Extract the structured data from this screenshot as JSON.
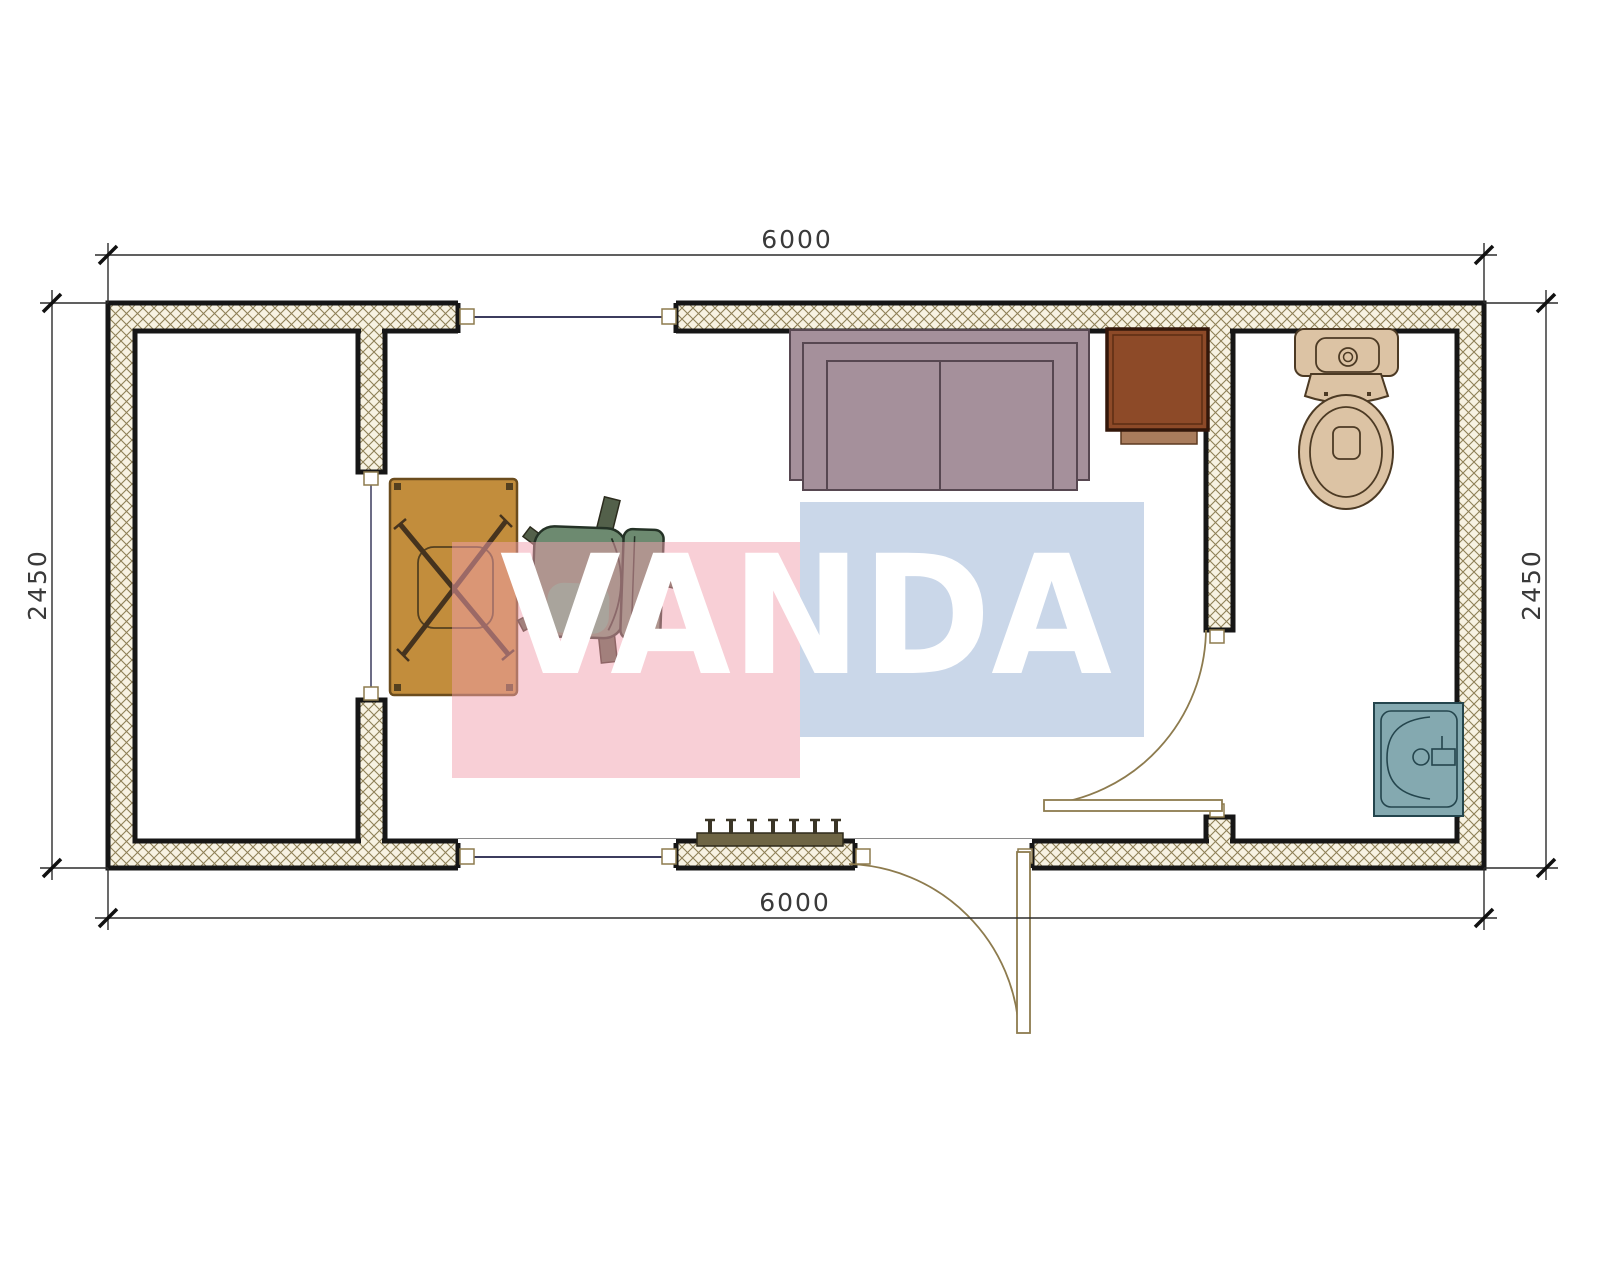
{
  "drawing": {
    "type": "container-cabin-floor-plan",
    "dimensions": {
      "top": "6000",
      "bottom": "6000",
      "left": "2450",
      "right": "2450"
    },
    "watermark": {
      "text": "VANDA",
      "pink_color": "#f2a0ae",
      "blue_color": "#96b0d4"
    },
    "colors": {
      "wall_hatch_bg": "#f7f2e2",
      "wall_hatch_line": "#8e8057",
      "wall_stroke": "#161616",
      "opening_line": "#3c3c5e",
      "door": "#8d7b4e",
      "desk": "#c28d3c",
      "chair": "#6d8a70",
      "sofa": "#a5909b",
      "cabinet": "#8d4a28",
      "toilet": "#dcc3a4",
      "sink": "#84a9b0",
      "radiator": "#6e6544"
    },
    "furniture": [
      "sofa",
      "cabinet",
      "desk",
      "office-chair",
      "toilet",
      "sink",
      "radiator"
    ],
    "openings": [
      "top-window",
      "bottom-window",
      "entrance-door",
      "bathroom-door",
      "left-room-opening"
    ]
  }
}
